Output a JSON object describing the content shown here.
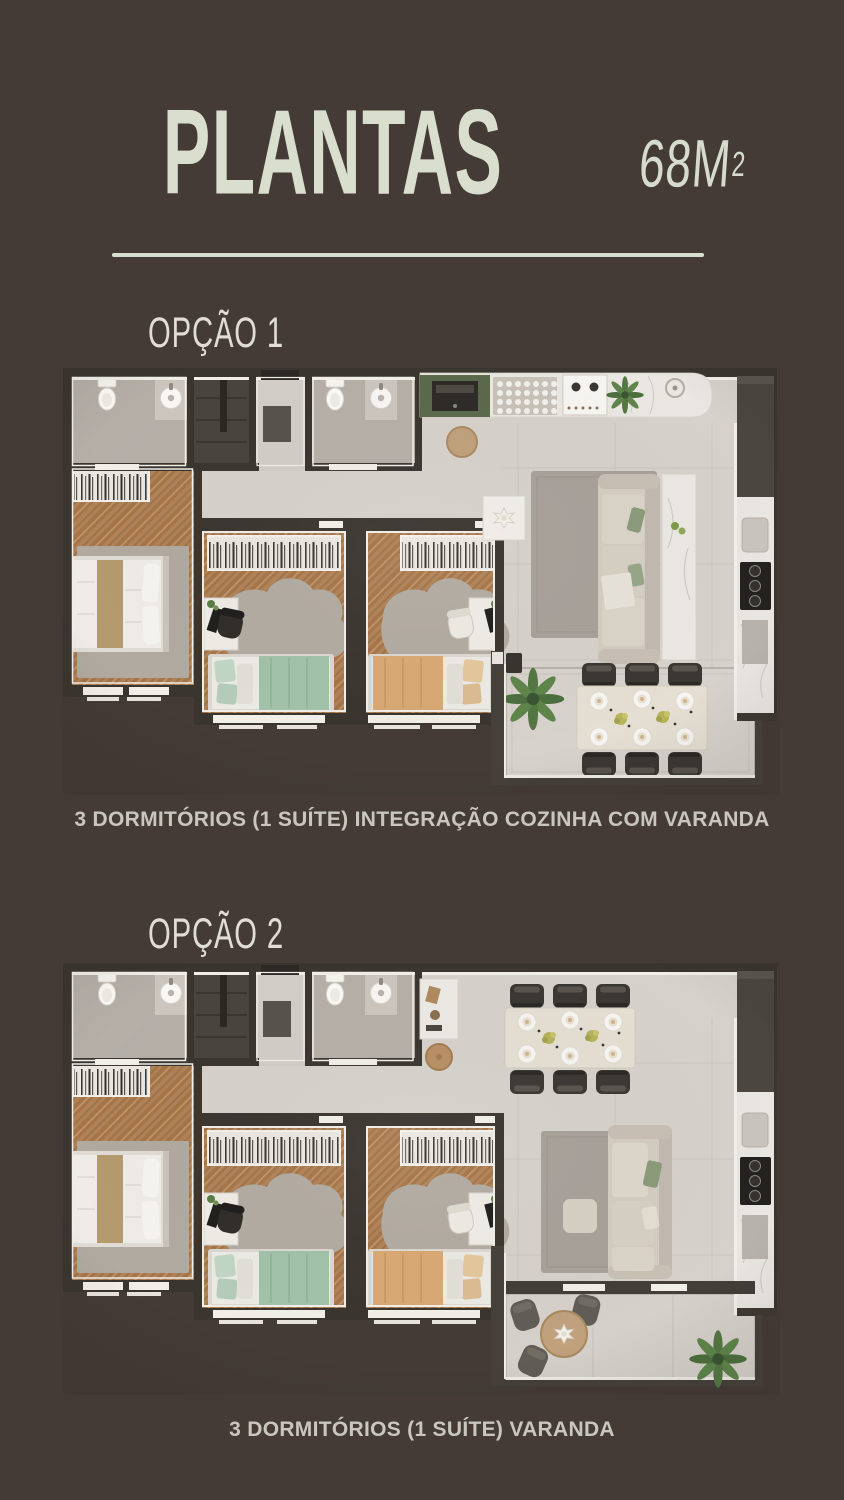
{
  "page": {
    "background_color": "#443b36",
    "width": 844,
    "height": 1500
  },
  "header": {
    "title": "PLANTAS",
    "area_value": "68M",
    "area_superscript": "2",
    "title_color": "#d9decf",
    "divider_color": "#d9ded1"
  },
  "options": [
    {
      "label": "OPÇÃO 1",
      "caption": "3 DORMITÓRIOS (1 SUÍTE) INTEGRAÇÃO COZINHA COM VARANDA",
      "floorplan": {
        "rooms": [
          "suite-master-bedroom",
          "bedroom-2",
          "bedroom-3",
          "bathroom-suite",
          "bathroom-social",
          "entry-hall",
          "kitchen-integrated",
          "living-room",
          "dining-varanda"
        ],
        "furniture": [
          "double-bed",
          "single-bed-green",
          "single-bed-tan",
          "wardrobes",
          "desks",
          "sofa",
          "marble-console",
          "kitchen-counter",
          "cooktop",
          "fridge-column",
          "dining-table-6-chairs",
          "ferns",
          "side-table"
        ]
      }
    },
    {
      "label": "OPÇÃO 2",
      "caption": "3 DORMITÓRIOS (1 SUÍTE) VARANDA",
      "floorplan": {
        "rooms": [
          "suite-master-bedroom",
          "bedroom-2",
          "bedroom-3",
          "bathroom-suite",
          "bathroom-social",
          "entry-hall",
          "kitchen",
          "dining-room",
          "living-room",
          "varanda-lounge"
        ],
        "furniture": [
          "double-bed",
          "single-bed-green",
          "single-bed-tan",
          "wardrobes",
          "desks",
          "dining-table-6-chairs",
          "marble-sideboard",
          "stool",
          "sofa",
          "round-lounge-table",
          "lounge-chairs",
          "fern"
        ]
      }
    }
  ],
  "palette": {
    "wall_dark": "#3b3530",
    "wall_lining": "#f2efe9",
    "tile_floor": "#d6d2cb",
    "bathroom_floor": "#b5afa8",
    "wood_floor": "#b28257",
    "rug_gray": "#a8a19a",
    "green_blanket": "#a2c2a9",
    "tan_blanket": "#d9a974",
    "sofa_beige": "#d3ccc1",
    "kitchen_cabinet_green": "#5b694c",
    "chair_dark": "#3b3733",
    "plant_green": "#557743",
    "marble": "#e9e6e1"
  }
}
